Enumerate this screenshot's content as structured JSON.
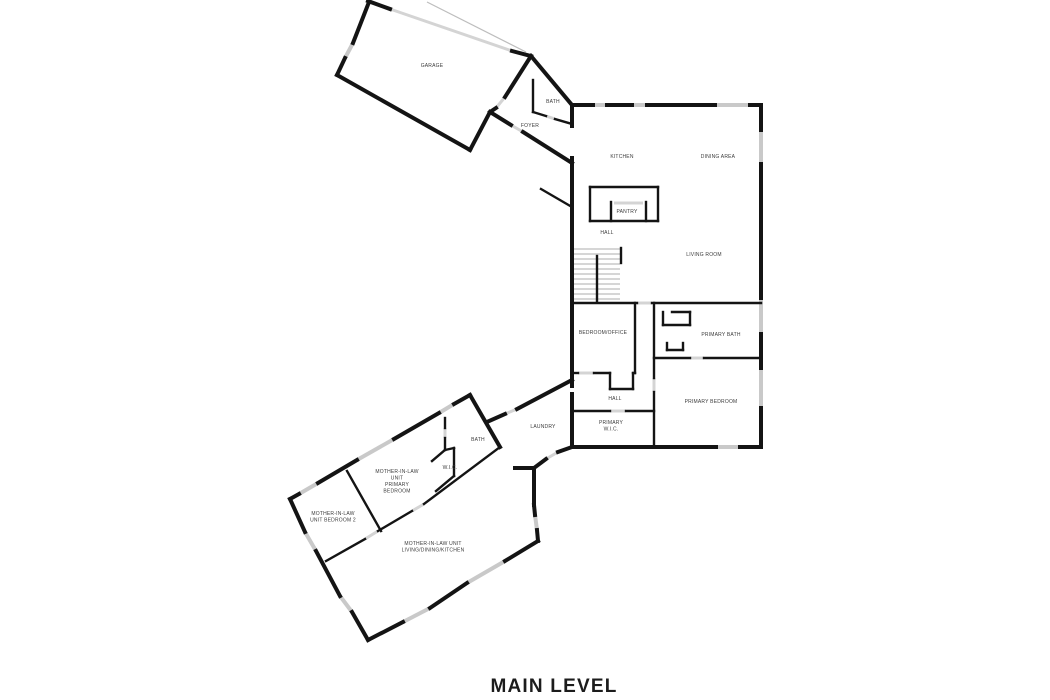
{
  "title": {
    "text": "MAIN LEVEL"
  },
  "colors": {
    "background": "#ffffff",
    "wall": "#141414",
    "window": "#c9c9c9",
    "door": "#d4d4d4",
    "thin_line": "#bdbdbd",
    "label": "#3c3c3c"
  },
  "canvas": {
    "width": 1050,
    "height": 700
  },
  "floorplan": {
    "rooms": [
      {
        "id": "garage",
        "x": 432,
        "y": 67,
        "lines": [
          "GARAGE"
        ]
      },
      {
        "id": "entry-bath",
        "x": 553,
        "y": 103,
        "lines": [
          "BATH"
        ]
      },
      {
        "id": "foyer",
        "x": 530,
        "y": 127,
        "lines": [
          "FOYER"
        ]
      },
      {
        "id": "kitchen",
        "x": 622,
        "y": 158,
        "lines": [
          "KITCHEN"
        ]
      },
      {
        "id": "dining-area",
        "x": 718,
        "y": 158,
        "lines": [
          "DINING AREA"
        ]
      },
      {
        "id": "pantry",
        "x": 627,
        "y": 213,
        "lines": [
          "PANTRY"
        ]
      },
      {
        "id": "hall-upper",
        "x": 607,
        "y": 234,
        "lines": [
          "HALL"
        ]
      },
      {
        "id": "living-room",
        "x": 704,
        "y": 256,
        "lines": [
          "LIVING ROOM"
        ]
      },
      {
        "id": "bedroom-office",
        "x": 603,
        "y": 334,
        "lines": [
          "BEDROOM/OFFICE"
        ]
      },
      {
        "id": "primary-bath",
        "x": 721,
        "y": 336,
        "lines": [
          "PRIMARY BATH"
        ]
      },
      {
        "id": "hall-lower",
        "x": 615,
        "y": 400,
        "lines": [
          "HALL"
        ]
      },
      {
        "id": "primary-bedroom",
        "x": 711,
        "y": 403,
        "lines": [
          "PRIMARY BEDROOM"
        ]
      },
      {
        "id": "primary-wic",
        "x": 611,
        "y": 424,
        "lines": [
          "PRIMARY",
          "W.I.C."
        ]
      },
      {
        "id": "laundry",
        "x": 543,
        "y": 428,
        "lines": [
          "LAUNDRY"
        ]
      },
      {
        "id": "mil-bath",
        "x": 478,
        "y": 441,
        "lines": [
          "BATH"
        ]
      },
      {
        "id": "mil-wic",
        "x": 450,
        "y": 469,
        "lines": [
          "W.I.C."
        ]
      },
      {
        "id": "mil-primary-bedroom",
        "x": 397,
        "y": 473,
        "lines": [
          "MOTHER-IN-LAW",
          "UNIT",
          "PRIMARY",
          "BEDROOM"
        ]
      },
      {
        "id": "mil-bedroom-2",
        "x": 333,
        "y": 515,
        "lines": [
          "MOTHER-IN-LAW",
          "UNIT BEDROOM 2"
        ]
      },
      {
        "id": "mil-living",
        "x": 433,
        "y": 545,
        "lines": [
          "MOTHER-IN-LAW UNIT",
          "LIVING/DINING/KITCHEN"
        ]
      }
    ],
    "walls_exterior": [
      [
        368,
        1,
        390,
        9
      ],
      [
        512,
        51,
        531,
        56
      ],
      [
        531,
        56,
        505,
        97
      ],
      [
        496,
        108,
        490,
        112
      ],
      [
        490,
        112,
        470,
        150
      ],
      [
        470,
        150,
        337,
        75
      ],
      [
        337,
        75,
        345,
        58
      ],
      [
        353,
        43,
        369,
        2
      ],
      [
        531,
        56,
        572,
        105
      ],
      [
        490,
        112,
        511,
        125
      ],
      [
        523,
        132,
        572,
        163
      ],
      [
        572,
        105,
        593,
        105
      ],
      [
        607,
        105,
        632,
        105
      ],
      [
        647,
        105,
        715,
        105
      ],
      [
        750,
        105,
        761,
        105
      ],
      [
        761,
        105,
        761,
        130
      ],
      [
        761,
        164,
        761,
        298
      ],
      [
        761,
        334,
        761,
        368
      ],
      [
        761,
        408,
        761,
        447
      ],
      [
        761,
        447,
        740,
        447
      ],
      [
        716,
        447,
        572,
        447
      ],
      [
        572,
        105,
        572,
        126
      ],
      [
        572,
        158,
        572,
        386
      ],
      [
        572,
        394,
        572,
        447
      ],
      [
        487,
        422,
        505,
        414
      ],
      [
        517,
        409,
        572,
        380
      ],
      [
        572,
        447,
        558,
        452
      ],
      [
        546,
        459,
        534,
        468
      ],
      [
        515,
        468,
        534,
        468
      ],
      [
        534,
        468,
        534,
        505
      ],
      [
        534,
        505,
        535,
        515
      ],
      [
        537,
        530,
        538,
        541
      ],
      [
        470,
        395,
        454,
        404
      ],
      [
        439,
        413,
        394,
        439
      ],
      [
        357,
        460,
        318,
        483
      ],
      [
        299,
        494,
        290,
        499
      ],
      [
        470,
        395,
        500,
        447
      ],
      [
        290,
        499,
        305,
        532
      ],
      [
        316,
        551,
        340,
        596
      ],
      [
        352,
        612,
        368,
        640
      ],
      [
        368,
        640,
        403,
        622
      ],
      [
        430,
        608,
        467,
        583
      ],
      [
        505,
        561,
        538,
        541
      ]
    ],
    "walls_interior": [
      [
        533,
        80,
        533,
        112
      ],
      [
        533,
        112,
        546,
        116
      ],
      [
        555,
        119,
        572,
        124
      ],
      [
        590,
        187,
        658,
        187
      ],
      [
        590,
        187,
        590,
        221
      ],
      [
        590,
        221,
        658,
        221
      ],
      [
        658,
        187,
        658,
        221
      ],
      [
        611,
        202,
        611,
        221
      ],
      [
        646,
        202,
        646,
        221
      ],
      [
        621,
        248,
        621,
        263
      ],
      [
        597,
        256,
        597,
        301
      ],
      [
        572,
        303,
        637,
        303
      ],
      [
        652,
        303,
        761,
        303
      ],
      [
        663,
        312,
        663,
        325
      ],
      [
        663,
        325,
        690,
        325
      ],
      [
        690,
        312,
        690,
        325
      ],
      [
        672,
        312,
        690,
        312
      ],
      [
        667,
        343,
        667,
        350
      ],
      [
        667,
        350,
        683,
        350
      ],
      [
        683,
        343,
        683,
        350
      ],
      [
        654,
        358,
        690,
        358
      ],
      [
        704,
        358,
        761,
        358
      ],
      [
        654,
        303,
        654,
        378
      ],
      [
        654,
        392,
        654,
        447
      ],
      [
        635,
        303,
        635,
        373
      ],
      [
        572,
        373,
        578,
        373
      ],
      [
        594,
        373,
        610,
        373
      ],
      [
        610,
        373,
        610,
        389
      ],
      [
        610,
        389,
        633,
        389
      ],
      [
        633,
        373,
        633,
        389
      ],
      [
        633,
        373,
        635,
        373
      ],
      [
        572,
        411,
        610,
        411
      ],
      [
        626,
        411,
        654,
        411
      ],
      [
        445,
        418,
        445,
        428
      ],
      [
        445,
        438,
        445,
        450
      ],
      [
        445,
        450,
        432,
        461
      ],
      [
        445,
        450,
        454,
        448
      ],
      [
        454,
        448,
        454,
        476
      ],
      [
        454,
        476,
        436,
        491
      ],
      [
        326,
        561,
        365,
        539
      ],
      [
        378,
        531,
        412,
        511
      ],
      [
        424,
        504,
        500,
        447
      ],
      [
        347,
        471,
        381,
        531
      ],
      [
        541,
        189,
        572,
        207
      ]
    ],
    "windows": [
      [
        345,
        58,
        353,
        43
      ],
      [
        593,
        105,
        607,
        105
      ],
      [
        632,
        105,
        647,
        105
      ],
      [
        715,
        105,
        750,
        105
      ],
      [
        761,
        130,
        761,
        164
      ],
      [
        761,
        298,
        761,
        334
      ],
      [
        761,
        368,
        761,
        408
      ],
      [
        740,
        447,
        716,
        447
      ],
      [
        535,
        515,
        537,
        530
      ],
      [
        454,
        404,
        439,
        413
      ],
      [
        394,
        439,
        357,
        460
      ],
      [
        318,
        483,
        299,
        494
      ],
      [
        305,
        532,
        316,
        551
      ],
      [
        340,
        596,
        352,
        612
      ],
      [
        403,
        622,
        430,
        608
      ],
      [
        467,
        583,
        505,
        561
      ]
    ],
    "doors": [
      [
        505,
        97,
        496,
        108
      ],
      [
        511,
        125,
        523,
        132
      ],
      [
        546,
        116,
        555,
        119
      ],
      [
        637,
        303,
        652,
        303
      ],
      [
        690,
        358,
        704,
        358
      ],
      [
        654,
        378,
        654,
        392
      ],
      [
        578,
        373,
        594,
        373
      ],
      [
        610,
        411,
        626,
        411
      ],
      [
        505,
        414,
        517,
        409
      ],
      [
        558,
        452,
        546,
        459
      ],
      [
        445,
        428,
        445,
        438
      ],
      [
        365,
        539,
        378,
        531
      ],
      [
        412,
        511,
        424,
        504
      ],
      [
        614,
        203,
        643,
        203
      ],
      [
        390,
        9,
        512,
        51
      ]
    ],
    "thin_lines": [
      [
        427,
        2,
        526,
        52
      ],
      [
        572,
        249,
        621,
        249
      ],
      [
        573,
        254,
        620,
        254
      ],
      [
        573,
        259,
        620,
        259
      ],
      [
        573,
        264,
        620,
        264
      ],
      [
        573,
        269,
        620,
        269
      ],
      [
        573,
        274,
        620,
        274
      ],
      [
        573,
        279,
        620,
        279
      ],
      [
        573,
        284,
        620,
        284
      ],
      [
        573,
        289,
        620,
        289
      ],
      [
        573,
        294,
        620,
        294
      ],
      [
        573,
        299,
        620,
        299
      ]
    ]
  }
}
